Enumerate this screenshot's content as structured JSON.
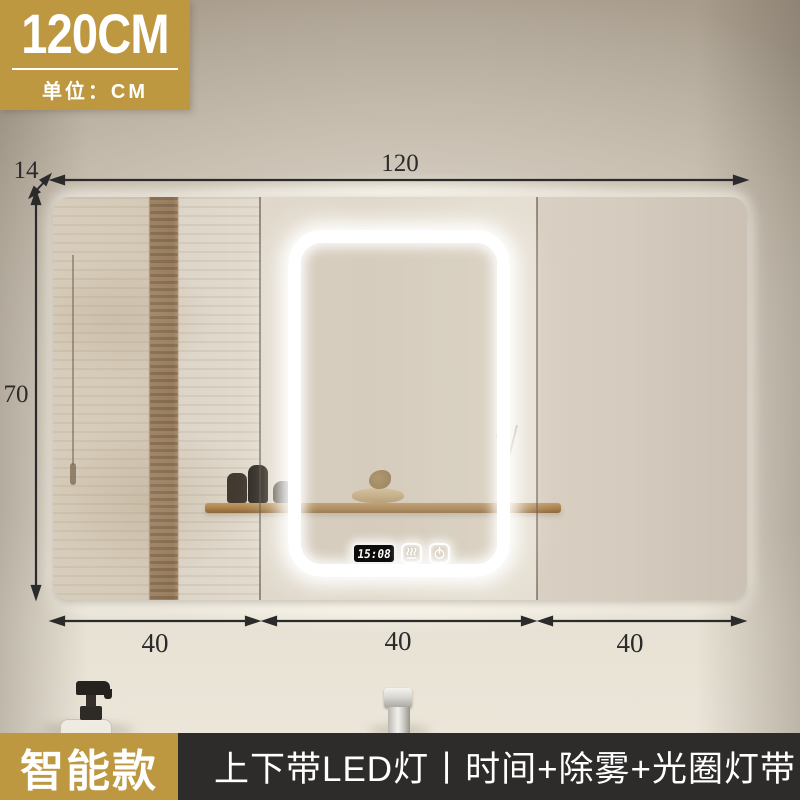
{
  "badge": {
    "size": "120CM",
    "unit": "单位：CM"
  },
  "dimensions": {
    "width": "120",
    "depth": "14",
    "height": "70",
    "doors": [
      "40",
      "40",
      "40"
    ]
  },
  "mirror": {
    "clock_time": "15:08",
    "buttons": [
      {
        "icon": "defog"
      },
      {
        "icon": "power"
      }
    ]
  },
  "footer": {
    "model": "智能款",
    "features": "上下带LED灯丨时间+除雾+光圈灯带"
  },
  "colors": {
    "accent_gold": "#BE9840",
    "footer_dark": "#2D2C2A",
    "dimension_line": "#2B2B2B",
    "led_glow": "#FFFFFF"
  }
}
